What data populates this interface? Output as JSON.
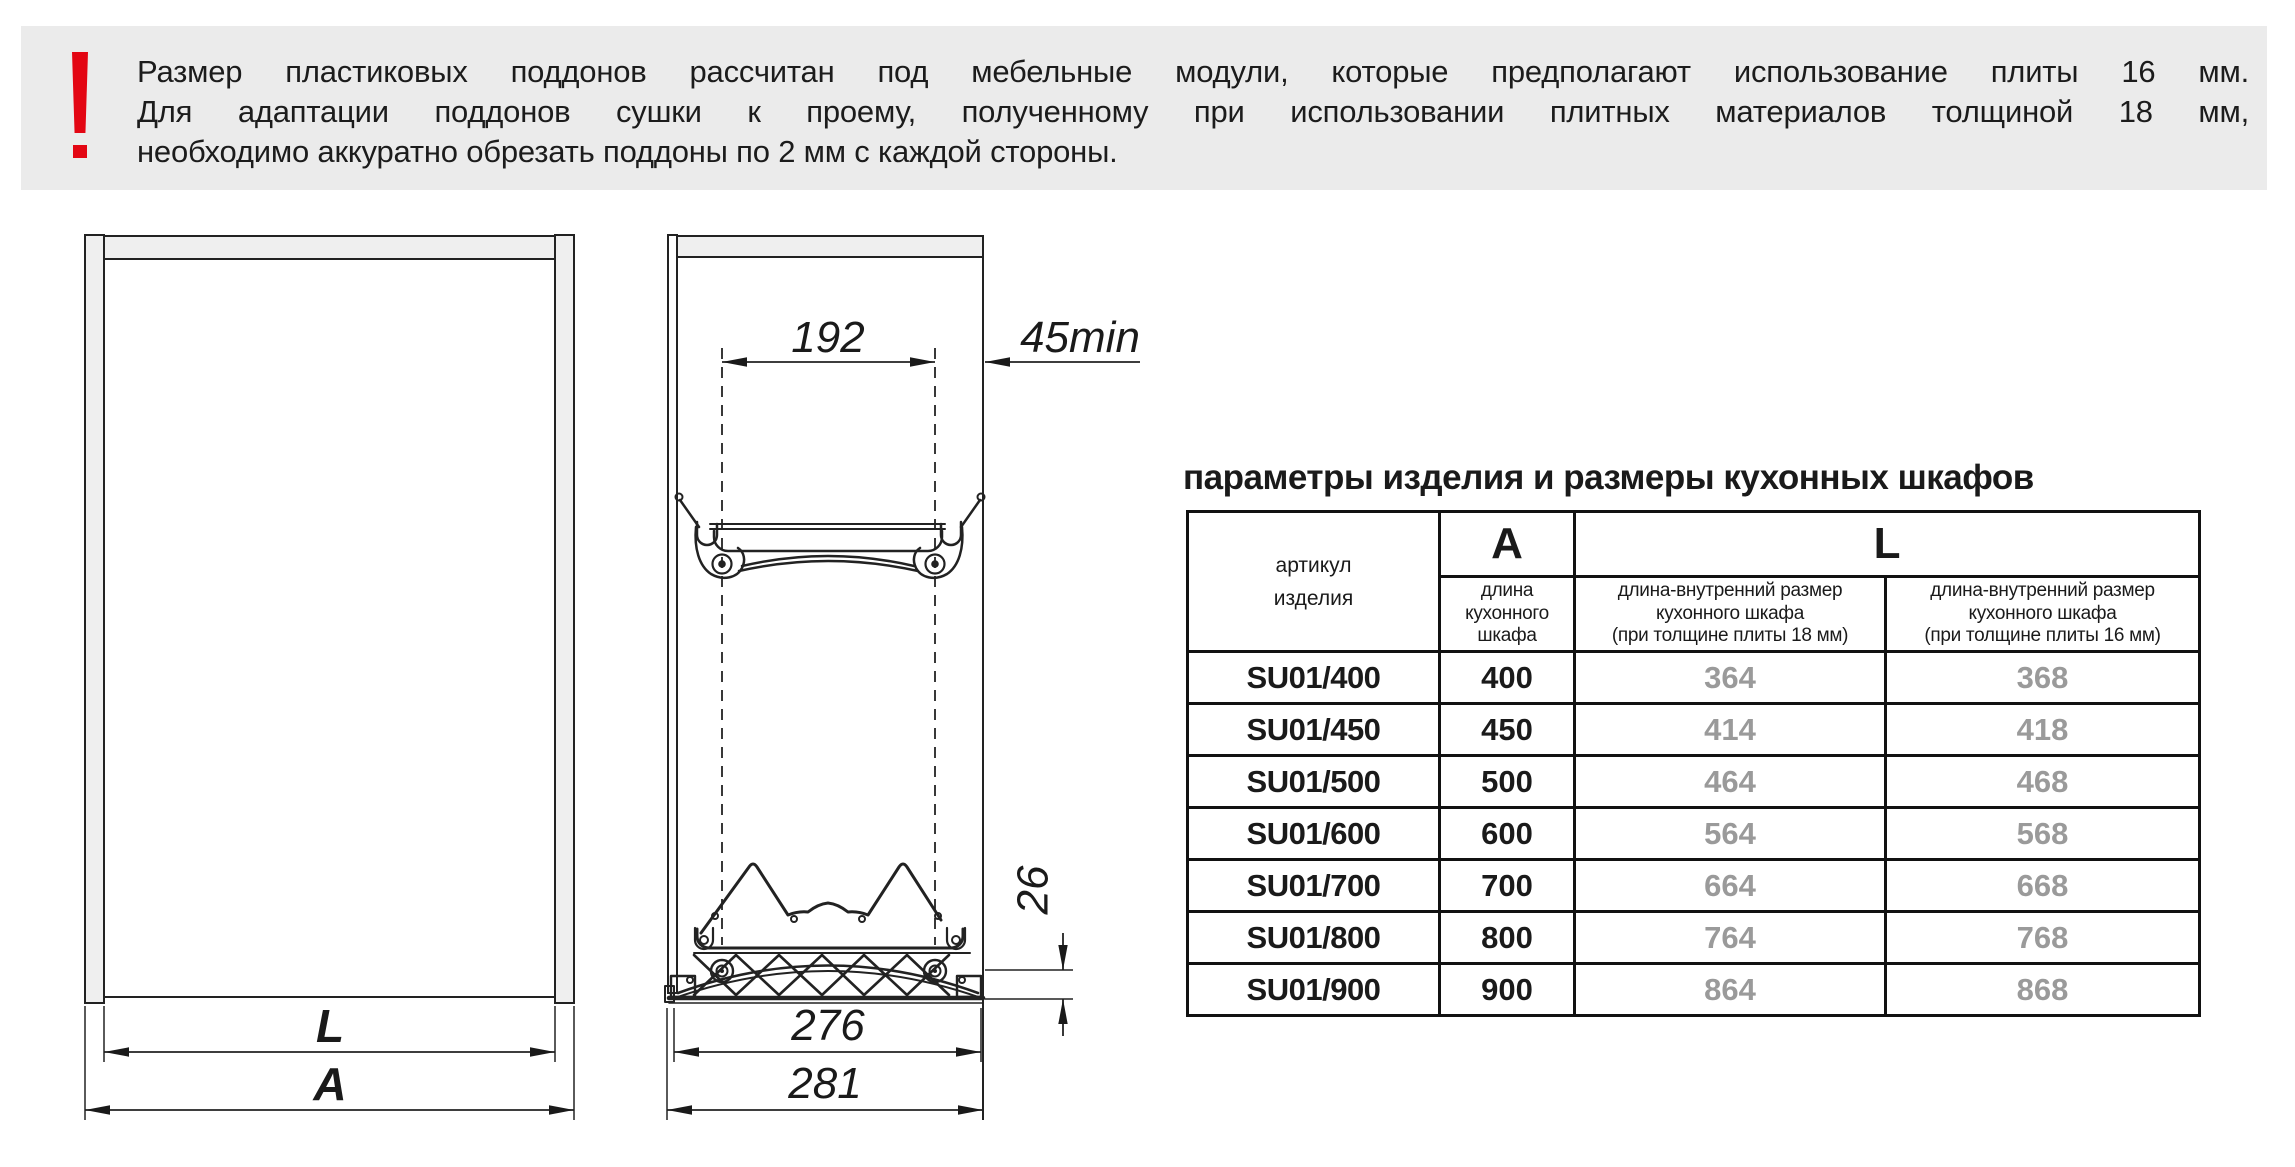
{
  "banner": {
    "warning_icon": "exclamation",
    "line1": "Размер пластиковых поддонов рассчитан под мебельные модули, которые предполагают использование плиты 16 мм.",
    "line2": "Для адаптации поддонов сушки к проему, полученному при использовании плитных материалов толщиной 18 мм,",
    "line3": "необходимо аккуратно обрезать поддоны по 2 мм с каждой стороны."
  },
  "drawings": {
    "front_view": {
      "dim_l": "L",
      "dim_a": "A"
    },
    "side_view": {
      "dim_192": "192",
      "dim_45min": "45min",
      "dim_26": "26",
      "dim_276": "276",
      "dim_281": "281"
    }
  },
  "table": {
    "title": "параметры изделия и размеры кухонных шкафов",
    "header": {
      "article": "артикул\nизделия",
      "a": "A",
      "l": "L",
      "a_sub": "длина\nкухонного\nшкафа",
      "l18_sub": "длина-внутренний размер\nкухонного шкафа\n(при толщине плиты 18 мм)",
      "l16_sub": "длина-внутренний размер\nкухонного шкафа\n(при толщине плиты 16 мм)"
    },
    "rows": [
      {
        "article": "SU01/400",
        "a": "400",
        "l18": "364",
        "l16": "368"
      },
      {
        "article": "SU01/450",
        "a": "450",
        "l18": "414",
        "l16": "418"
      },
      {
        "article": "SU01/500",
        "a": "500",
        "l18": "464",
        "l16": "468"
      },
      {
        "article": "SU01/600",
        "a": "600",
        "l18": "564",
        "l16": "568"
      },
      {
        "article": "SU01/700",
        "a": "700",
        "l18": "664",
        "l16": "668"
      },
      {
        "article": "SU01/800",
        "a": "800",
        "l18": "764",
        "l16": "768"
      },
      {
        "article": "SU01/900",
        "a": "900",
        "l18": "864",
        "l16": "868"
      }
    ]
  },
  "colors": {
    "accent_red": "#e30613",
    "banner_gray": "#ebebeb",
    "panel_gray": "#efefef",
    "line_dark": "#222222",
    "value_gray": "#9a9a9a"
  }
}
